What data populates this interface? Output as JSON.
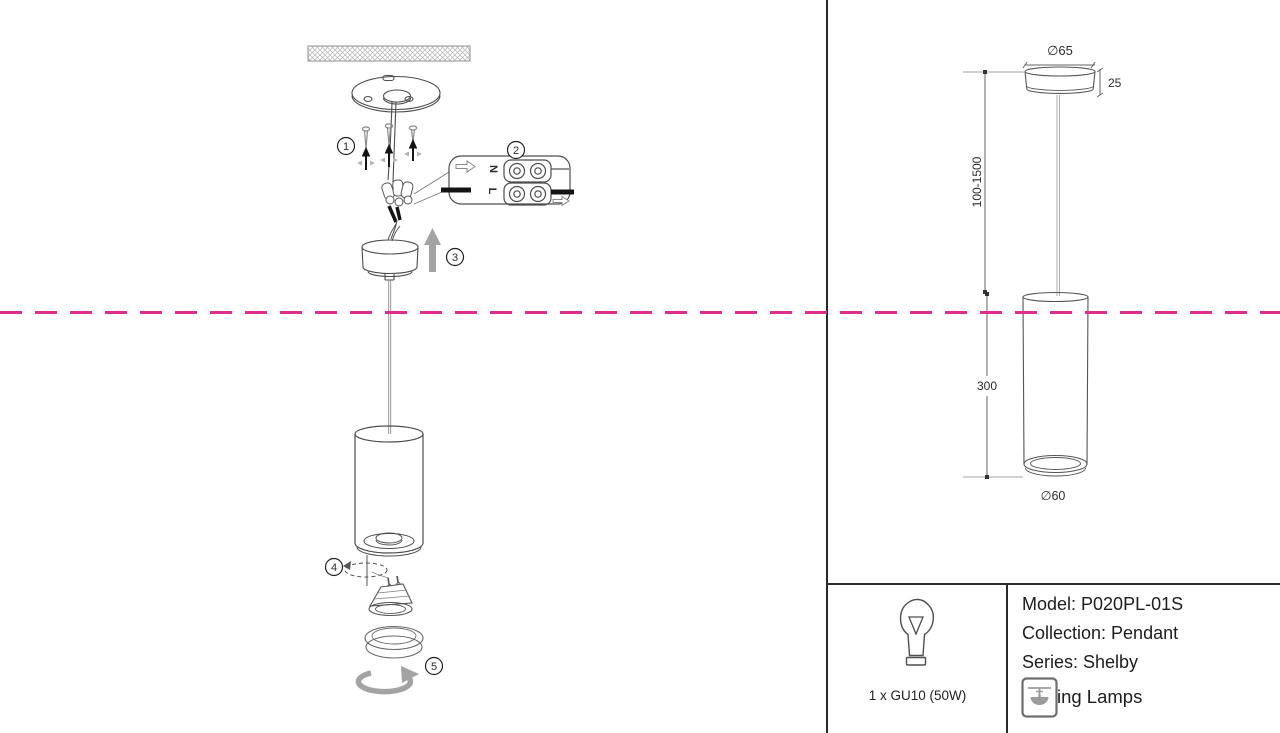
{
  "steps": [
    "1",
    "2",
    "3",
    "4",
    "5"
  ],
  "wiring": {
    "neutral_label": "N",
    "live_label": "L"
  },
  "dims": {
    "canopy_diameter": "∅65",
    "canopy_height": "25",
    "suspension_length": "100-1500",
    "body_height": "300",
    "body_diameter": "∅60"
  },
  "info": {
    "model": "Model: P020PL-01S",
    "collection": "Collection: Pendant",
    "series": "Series: Shelby",
    "category": "Ceilling Lamps",
    "lamp_spec": "1 x GU10 (50W)"
  },
  "colors": {
    "accent_pink": "#de2d8a",
    "arrow_gray": "#a3a3a3"
  }
}
